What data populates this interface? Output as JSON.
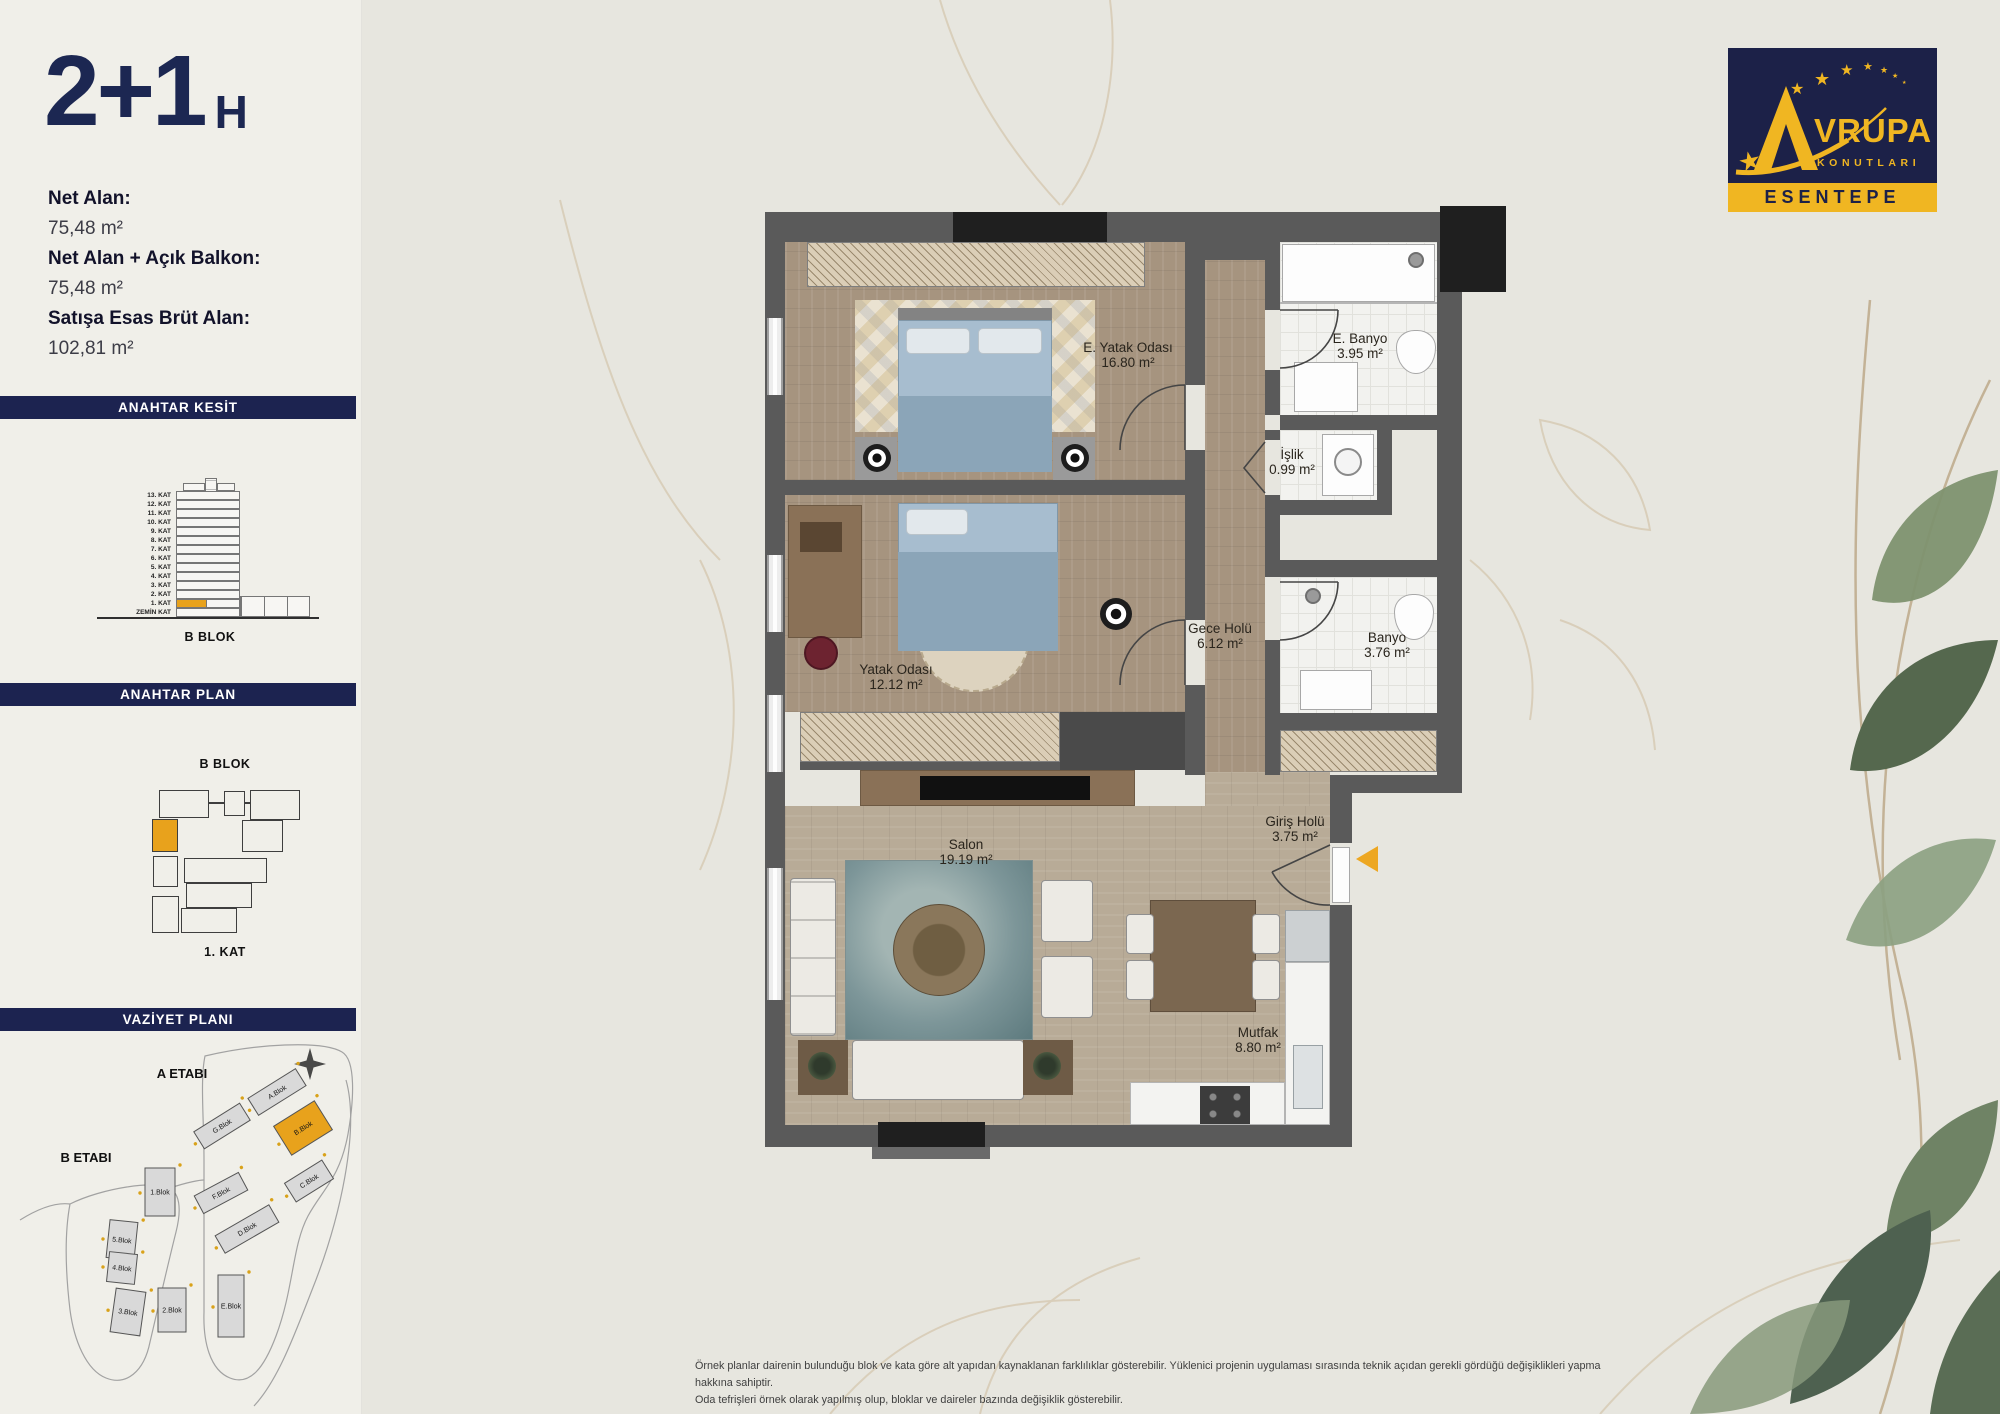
{
  "header": {
    "title": "2+1",
    "suffix": "H"
  },
  "areas": {
    "net_label": "Net Alan:",
    "net_value": "75,48 m²",
    "net_balkon_label": "Net Alan + Açık Balkon:",
    "net_balkon_value": "75,48 m²",
    "brut_label": "Satışa Esas Brüt Alan:",
    "brut_value": "102,81 m²"
  },
  "sections": {
    "kesit": {
      "title": "ANAHTAR KESİT",
      "block_label": "B BLOK",
      "floors": [
        "13. KAT",
        "12. KAT",
        "11. KAT",
        "10. KAT",
        "9. KAT",
        "8. KAT",
        "7. KAT",
        "6. KAT",
        "5. KAT",
        "4. KAT",
        "3. KAT",
        "2. KAT",
        "1. KAT",
        "ZEMİN KAT"
      ],
      "highlight_floor": "1. KAT"
    },
    "plan": {
      "title": "ANAHTAR PLAN",
      "block_label": "B BLOK",
      "floor_label": "1. KAT"
    },
    "vaziyet": {
      "title": "VAZİYET PLANI",
      "etap_a": "A ETABI",
      "etap_b": "B ETABI",
      "highlight_block": "B.Blok",
      "blocks": [
        {
          "label": "A.Blok"
        },
        {
          "label": "G.Blok"
        },
        {
          "label": "B.Blok",
          "highlight": true
        },
        {
          "label": "C.Blok"
        },
        {
          "label": "F.Blok"
        },
        {
          "label": "D.Blok"
        },
        {
          "label": "E.Blok"
        },
        {
          "label": "1.Blok"
        },
        {
          "label": "5.Blok"
        },
        {
          "label": "4.Blok"
        },
        {
          "label": "3.Blok"
        },
        {
          "label": "2.Blok"
        }
      ]
    }
  },
  "floorplan": {
    "rooms": [
      {
        "name": "E. Yatak Odası",
        "area": "16.80 m²"
      },
      {
        "name": "E. Banyo",
        "area": "3.95 m²"
      },
      {
        "name": "İşlik",
        "area": "0.99 m²"
      },
      {
        "name": "Banyo",
        "area": "3.76 m²"
      },
      {
        "name": "Gece Holü",
        "area": "6.12 m²"
      },
      {
        "name": "Yatak Odası",
        "area": "12.12 m²"
      },
      {
        "name": "Salon",
        "area": "19.19 m²"
      },
      {
        "name": "Giriş Holü",
        "area": "3.75 m²"
      },
      {
        "name": "Mutfak",
        "area": "8.80 m²"
      }
    ]
  },
  "logo": {
    "brand_rest": "VRUPA",
    "brand_sub": "KONUTLARI",
    "project": "ESENTEPE"
  },
  "disclaimer": {
    "line1": "Örnek planlar dairenin bulunduğu blok ve kata göre alt yapıdan kaynaklanan farklılıklar gösterebilir. Yüklenici projenin uygulaması sırasında teknik açıdan gerekli gördüğü değişiklikleri yapma hakkına sahiptir.",
    "line2": "Oda tefrişleri örnek olarak yapılmış olup, bloklar ve daireler bazında değişiklik gösterebilir."
  },
  "colors": {
    "navy": "#1c2350",
    "gold": "#eda722",
    "wall": "#5a5a5a",
    "paper": "#e7e6df",
    "highlight": "#e8a21c"
  }
}
